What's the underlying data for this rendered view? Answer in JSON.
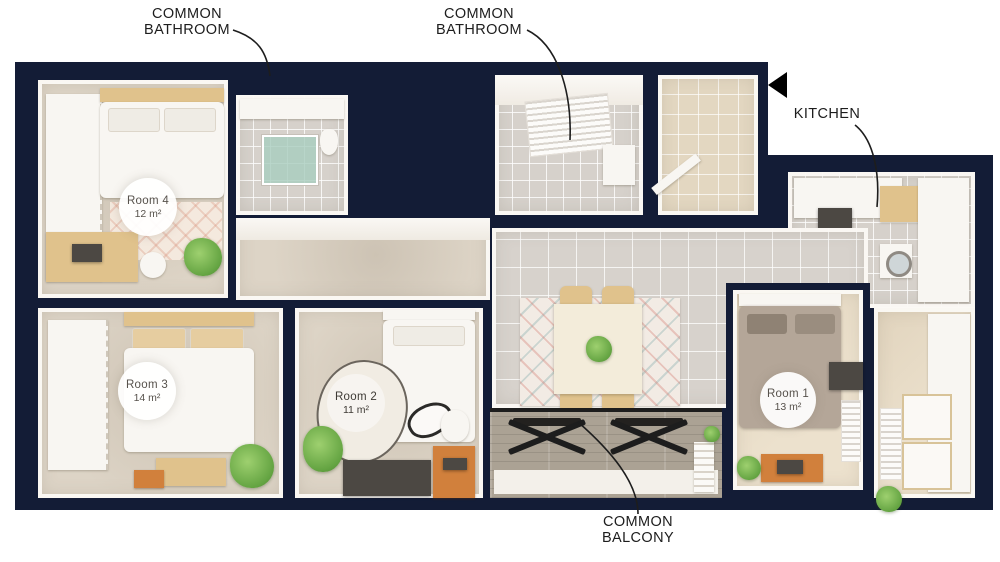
{
  "callouts": {
    "bathroom1": {
      "line1": "COMMON",
      "line2": "BATHROOM"
    },
    "bathroom2": {
      "line1": "COMMON",
      "line2": "BATHROOM"
    },
    "kitchen": {
      "label": "KITCHEN"
    },
    "balcony": {
      "line1": "COMMON",
      "line2": "BALCONY"
    }
  },
  "rooms": [
    {
      "name": "Room 4",
      "area": "12 m²"
    },
    {
      "name": "Room 3",
      "area": "14 m²"
    },
    {
      "name": "Room 2",
      "area": "11 m²"
    },
    {
      "name": "Room 1",
      "area": "13 m²"
    }
  ],
  "icons": {
    "entrance_marker": "left-pointing-triangle"
  },
  "colors": {
    "wall": "#131c36",
    "background": "#ffffff",
    "tile_floor": "#d7d2cc",
    "wood_floor": "#ece1cd",
    "balcony_floor": "#aba294",
    "accent_orange": "#d1803c",
    "plant_green": "#64a442",
    "label_text": "#1d1d1d"
  }
}
